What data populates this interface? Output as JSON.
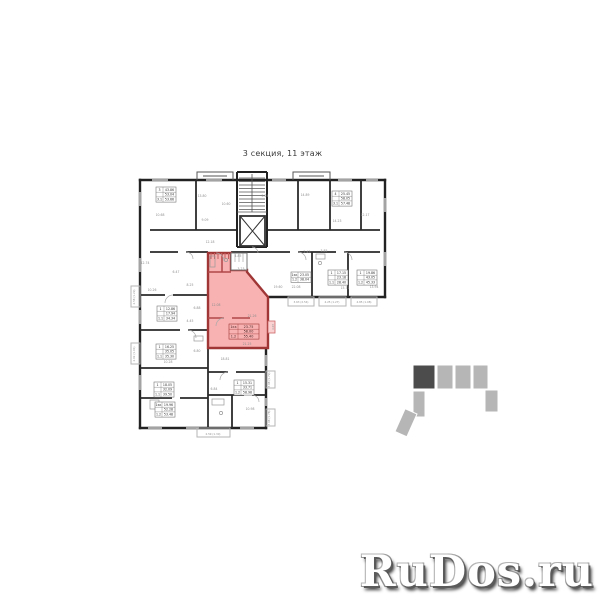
{
  "title": "3 секция, 11 этаж",
  "watermark": "RuDos.ru",
  "colors": {
    "highlight_fill": "#f8b2b2",
    "highlight_wall": "#a03636",
    "wall": "#222222",
    "thin_wall": "#8a8a8a",
    "dim_text": "#8f8f8f",
    "table_text": "#333333",
    "highlight_table_text": "#4a2424",
    "indicator_dark": "#4c4c4c",
    "indicator_light": "#b6b6b6"
  },
  "plan": {
    "highlight_table": {
      "x": 229,
      "y": 324,
      "rows": [
        "1кк  23.75",
        "58.00",
        "1.2  55.40"
      ]
    },
    "tables": [
      {
        "x": 156,
        "y": 187,
        "rows": [
          "3  43.86",
          "53.04",
          "3.1  53.66"
        ]
      },
      {
        "x": 332,
        "y": 191,
        "rows": [
          "4  25.45",
          "58.05",
          "3.1  57.48"
        ]
      },
      {
        "x": 291,
        "y": 272,
        "rows": [
          "1кк  23.05",
          "1.2  38.04"
        ]
      },
      {
        "x": 328,
        "y": 270,
        "rows": [
          "1  17.15",
          "23.18",
          "1.1  28.40"
        ]
      },
      {
        "x": 357,
        "y": 270,
        "rows": [
          "1  19.86",
          "43.05",
          "1.2  45.33"
        ]
      },
      {
        "x": 157,
        "y": 306,
        "rows": [
          "1  12.86",
          "17.94",
          "1.1  34.34"
        ]
      },
      {
        "x": 156,
        "y": 344,
        "rows": [
          "1  16.25",
          "35.05",
          "1.1  35.30"
        ]
      },
      {
        "x": 154,
        "y": 382,
        "rows": [
          "1  18.05",
          "32.09",
          "1.1  39.50"
        ]
      },
      {
        "x": 234,
        "y": 380,
        "rows": [
          "1  15.31",
          "33.71",
          "1.2  58.98"
        ]
      },
      {
        "x": 155,
        "y": 402,
        "rows": [
          "1кк  19.96",
          "52.28",
          "1.2  53.48"
        ]
      }
    ],
    "dims": [
      {
        "x": 202,
        "y": 197,
        "t": "13.80"
      },
      {
        "x": 160,
        "y": 216,
        "t": "10.68"
      },
      {
        "x": 205,
        "y": 221,
        "t": "9.09"
      },
      {
        "x": 226,
        "y": 205,
        "t": "10.60"
      },
      {
        "x": 265,
        "y": 197,
        "t": "5.24"
      },
      {
        "x": 305,
        "y": 196,
        "t": "14.89"
      },
      {
        "x": 337,
        "y": 222,
        "t": "14.23"
      },
      {
        "x": 365,
        "y": 216,
        "t": "12.17"
      },
      {
        "x": 145,
        "y": 264,
        "t": "12.74"
      },
      {
        "x": 176,
        "y": 273,
        "t": "6.47"
      },
      {
        "x": 190,
        "y": 286,
        "t": "8.25"
      },
      {
        "x": 152,
        "y": 291,
        "t": "10.26"
      },
      {
        "x": 197,
        "y": 309,
        "t": "6.88"
      },
      {
        "x": 190,
        "y": 322,
        "t": "4.45"
      },
      {
        "x": 197,
        "y": 352,
        "t": "6.80"
      },
      {
        "x": 168,
        "y": 363,
        "t": "10.28"
      },
      {
        "x": 238,
        "y": 257,
        "t": "4.85"
      },
      {
        "x": 241,
        "y": 270,
        "t": "3.23"
      },
      {
        "x": 216,
        "y": 306,
        "t": "12.08"
      },
      {
        "x": 252,
        "y": 317,
        "t": "21.26"
      },
      {
        "x": 247,
        "y": 345,
        "t": "21.25"
      },
      {
        "x": 278,
        "y": 288,
        "t": "19.60"
      },
      {
        "x": 296,
        "y": 288,
        "t": "22.08"
      },
      {
        "x": 345,
        "y": 289,
        "t": "15.71"
      },
      {
        "x": 374,
        "y": 288,
        "t": "13.94"
      },
      {
        "x": 307,
        "y": 253,
        "t": "2.45"
      },
      {
        "x": 324,
        "y": 252,
        "t": "3.85"
      },
      {
        "x": 225,
        "y": 360,
        "t": "18.81"
      },
      {
        "x": 214,
        "y": 390,
        "t": "6.84"
      },
      {
        "x": 250,
        "y": 410,
        "t": "10.98"
      },
      {
        "x": 210,
        "y": 243,
        "t": "12.18"
      }
    ],
    "balcony_labels": [
      {
        "x": 301,
        "y": 303,
        "t": "3.63 (2.54)"
      },
      {
        "x": 332,
        "y": 303,
        "t": "4.25 (1.27)"
      },
      {
        "x": 364,
        "y": 303,
        "t": "4.85 (1.08)"
      },
      {
        "x": 270,
        "y": 380,
        "t": "3.08 (1.79)",
        "r": -90
      },
      {
        "x": 270,
        "y": 418,
        "t": "3.08 (1.78)",
        "r": -90
      },
      {
        "x": 135,
        "y": 297,
        "t": "2.58 (1.29)",
        "r": -90
      },
      {
        "x": 135,
        "y": 354,
        "t": "2.02 (1.01)",
        "r": -90
      },
      {
        "x": 213,
        "y": 435,
        "t": "2.59 (1.30)"
      },
      {
        "x": 274,
        "y": 327,
        "t": "4.03",
        "r": -90
      }
    ]
  }
}
